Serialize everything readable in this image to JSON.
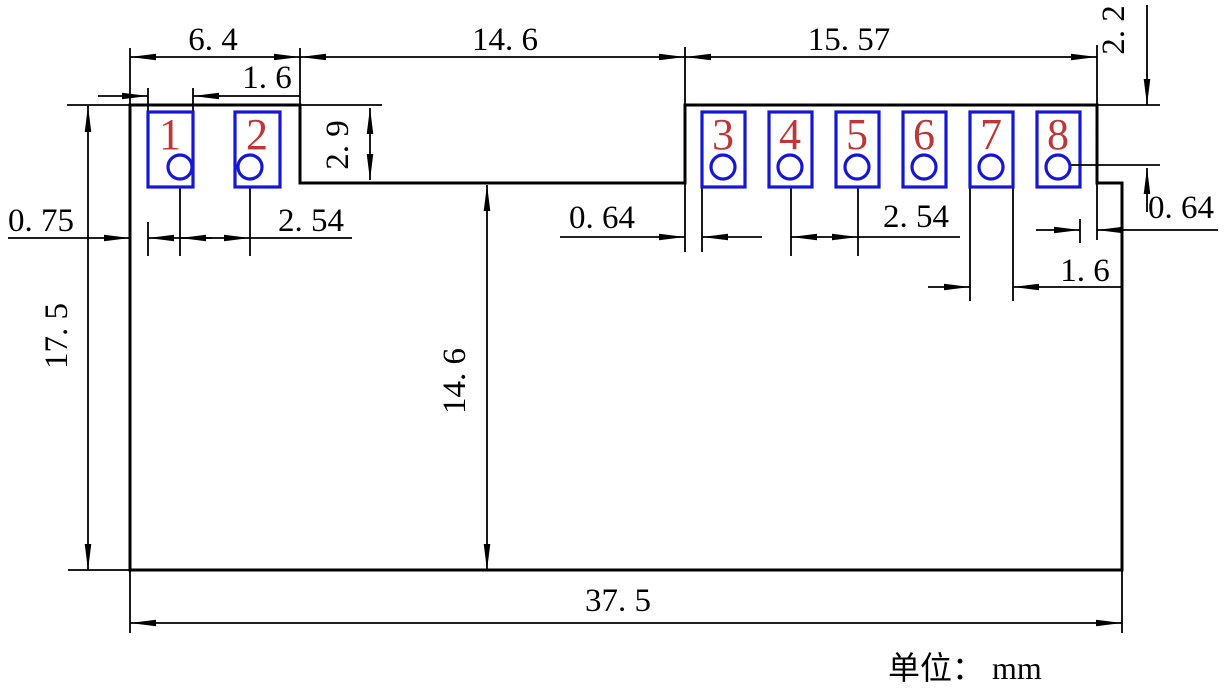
{
  "drawing": {
    "type": "mechanical-dimension-drawing",
    "units_note": "单位： mm",
    "pins": [
      {
        "number": "1"
      },
      {
        "number": "2"
      },
      {
        "number": "3"
      },
      {
        "number": "4"
      },
      {
        "number": "5"
      },
      {
        "number": "6"
      },
      {
        "number": "7"
      },
      {
        "number": "8"
      }
    ],
    "dims": {
      "left_tab_width": "6. 4",
      "pad1_width": "1. 6",
      "notch_width": "14. 6",
      "right_tab_width": "15. 57",
      "pin_row_offset": "2. 2",
      "tab_height": "2. 9",
      "left_edge_to_pad1": "0. 75",
      "left_pitch": "2. 54",
      "edge_to_pad3": "0. 64",
      "right_pitch": "2. 54",
      "pad8_to_edge": "0. 64",
      "pad7_width": "1. 6",
      "total_height": "17. 5",
      "body_height": "14. 6",
      "total_width": "37. 5"
    },
    "colors": {
      "line": "#000000",
      "pad_outline": "#1616d6",
      "pin_number": "#c03535",
      "background": "#ffffff"
    }
  }
}
